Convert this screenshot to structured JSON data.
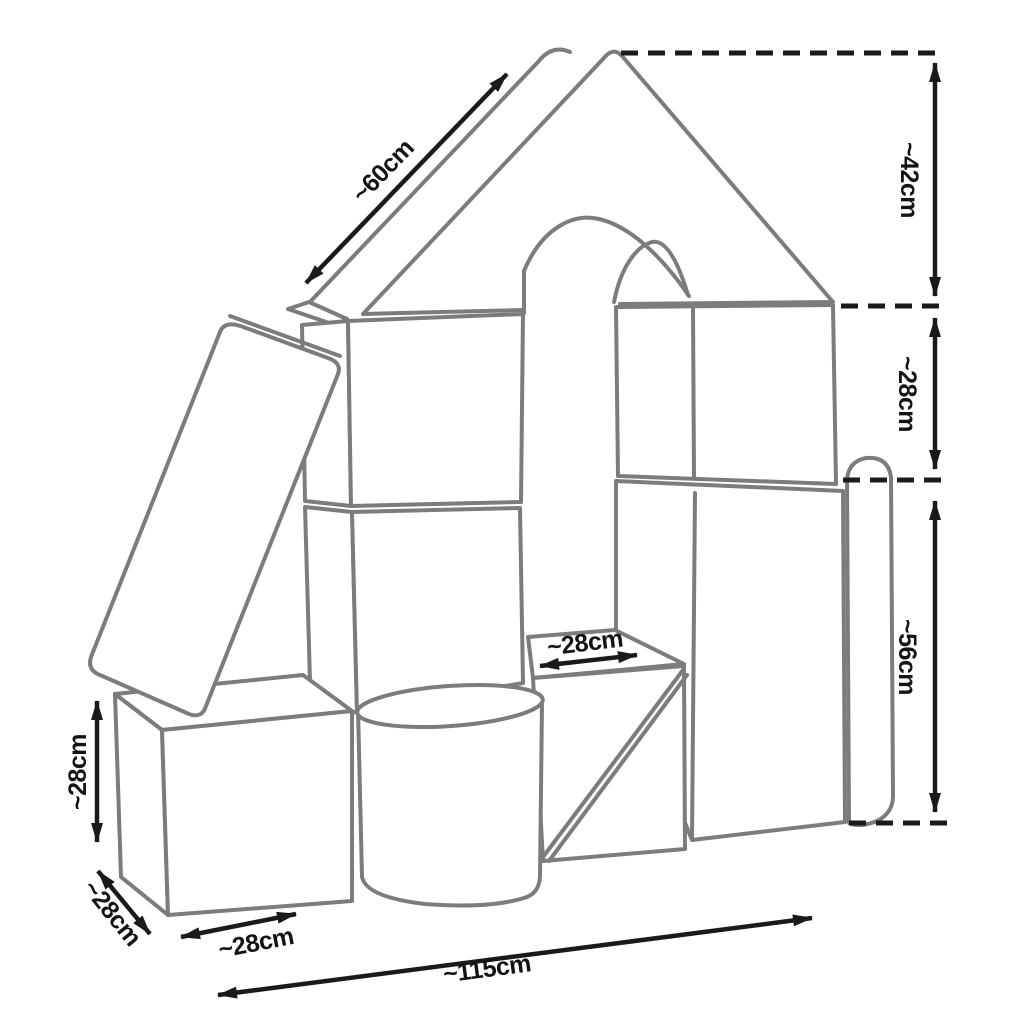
{
  "diagram": {
    "type": "product-dimension-diagram",
    "subject": "foam-building-blocks-house",
    "units": "cm",
    "dimensions": {
      "roof_slope_length": "~60cm",
      "roof_height": "~42cm",
      "upper_wall_height": "~28cm",
      "column_height": "~56cm",
      "arch_opening_width": "~28cm",
      "left_cube_height": "~28cm",
      "cube_depth": "~28cm",
      "cube_width": "~28cm",
      "total_width": "~115cm"
    },
    "colors": {
      "block_outline": "#7c7c7c",
      "dimension_lines": "#1a1a1a",
      "background": "#ffffff"
    }
  }
}
